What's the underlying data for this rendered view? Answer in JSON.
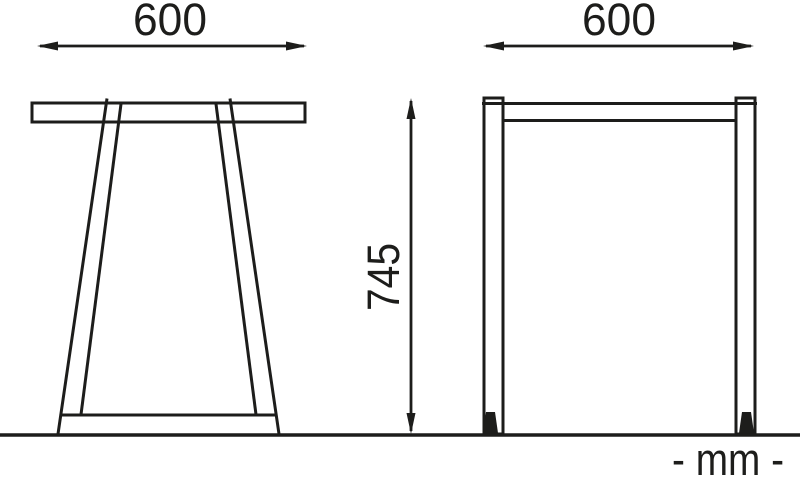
{
  "page": {
    "background": "#ffffff",
    "ink_color": "#1d1d1b"
  },
  "drawing": {
    "front_view": {
      "width_dimension_mm": "600"
    },
    "side_view": {
      "width_dimension_mm": "600",
      "height_dimension_mm": "745"
    },
    "units_label": "- mm -"
  }
}
